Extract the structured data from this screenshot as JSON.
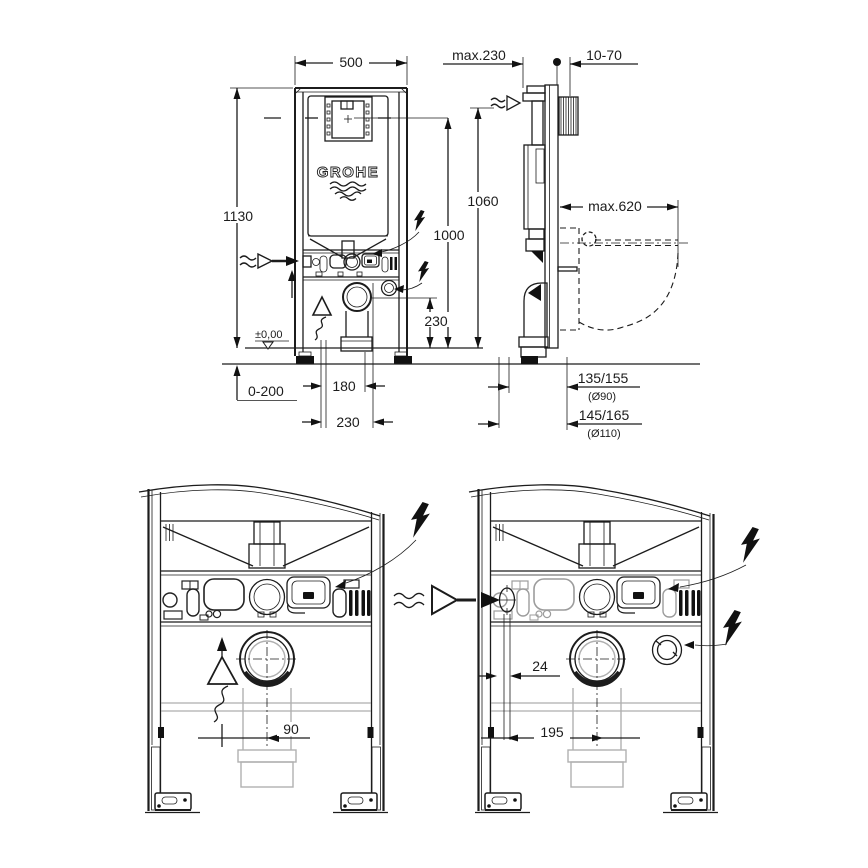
{
  "brand": "GROHE",
  "colors": {
    "line": "#1c1c1c",
    "muted": "#9c9c9c",
    "pipe_gray": "#b0b0b0"
  },
  "symbols": {
    "electrical_connection": "lightning-bolt-icon",
    "water_supply": "wavy-arrow-icon",
    "vent": "triangle-squiggle-icon",
    "floor_reference": "level-triangle-icon"
  },
  "views": {
    "front": {
      "width": "500",
      "height": "1130",
      "actuation_height": "1000",
      "drain_center_height": "230",
      "floor_level": "±0,00",
      "floor_buildup": "0-200",
      "offset_a": "180",
      "offset_b": "230"
    },
    "side": {
      "frame_depth": "max.230",
      "wall_distance": "10-70",
      "supply_height": "1060",
      "bowl_clearance": "max.620",
      "outlet_90": "135/155",
      "outlet_90_dia": "(Ø90)",
      "outlet_110": "145/165",
      "outlet_110_dia": "(Ø110)"
    },
    "bottom_left": {
      "drain_offset": "90"
    },
    "bottom_right": {
      "inlet_offset": "24",
      "drain_offset": "195"
    }
  }
}
